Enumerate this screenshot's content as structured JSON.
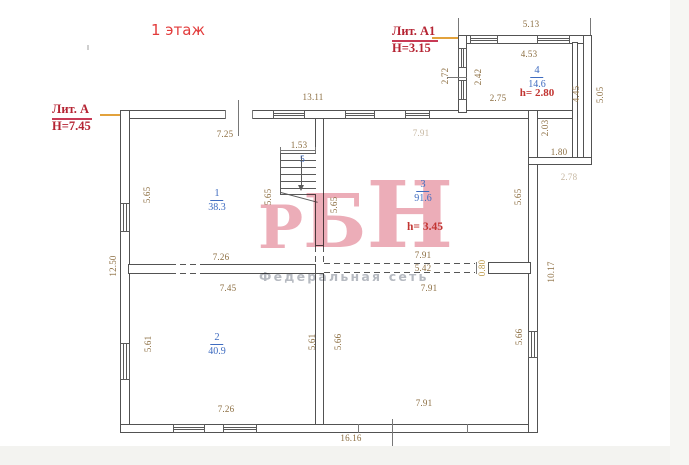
{
  "title": "1 этаж",
  "liters": {
    "a": {
      "name": "Лит. А",
      "h": "H=7.45"
    },
    "a1": {
      "name": "Лит. А1",
      "h": "H=3.15"
    }
  },
  "rooms": {
    "r1": {
      "num": "1",
      "area": "38.3"
    },
    "r2": {
      "num": "2",
      "area": "40.9"
    },
    "r3": {
      "num": "3",
      "area": "91.6",
      "h": "h= 3.45"
    },
    "r4": {
      "num": "4",
      "area": "14.6",
      "h": "h= 2.80"
    },
    "r5": {
      "num": "5"
    }
  },
  "dims": {
    "annex_top": "5.13",
    "annex_room_top": "4.53",
    "annex_left_outer": "2.72",
    "annex_left_inner": "2.42",
    "annex_inner_w": "2.75",
    "annex_right_inner": "4.45",
    "annex_right_outer": "5.05",
    "annex_lower_h": "2.03",
    "annex_lower_w": "1.80",
    "annex_below": "2.78",
    "main_top": "13.11",
    "room1_top": "7.25",
    "stair_top": "1.53",
    "room3_top": "7.91",
    "room1_left": "5.65",
    "room1_right": "5.65",
    "room3_left": "5.65",
    "room3_right": "5.65",
    "left_outer": "12.50",
    "right_outer": "10.17",
    "room1_bottom": "7.26",
    "room2_top": "7.45",
    "room3_bottom": "7.91",
    "dashed_len": "5.42",
    "opening": "0.80",
    "lower_right_top": "7.91",
    "room2_left": "5.61",
    "room2_right": "5.61",
    "lower_right_left": "5.66",
    "lower_right_right": "5.66",
    "room2_bottom": "7.26",
    "lower_right_bottom": "7.91",
    "main_bottom": "16.16"
  },
  "watermark": {
    "letters": [
      "Р",
      "Б",
      "Н"
    ],
    "sub": "Федеральная сеть"
  },
  "colors": {
    "wall": "#525252",
    "dimension_text": "#8c6e41",
    "room_text": "#3f6cc0",
    "height_text": "#c23431",
    "liter_text": "#b52433",
    "title_text": "#e23b3b",
    "pointer_line": "#e2a23c",
    "watermark_pink": "#ecadb8",
    "watermark_gray": "#b6bac1"
  }
}
